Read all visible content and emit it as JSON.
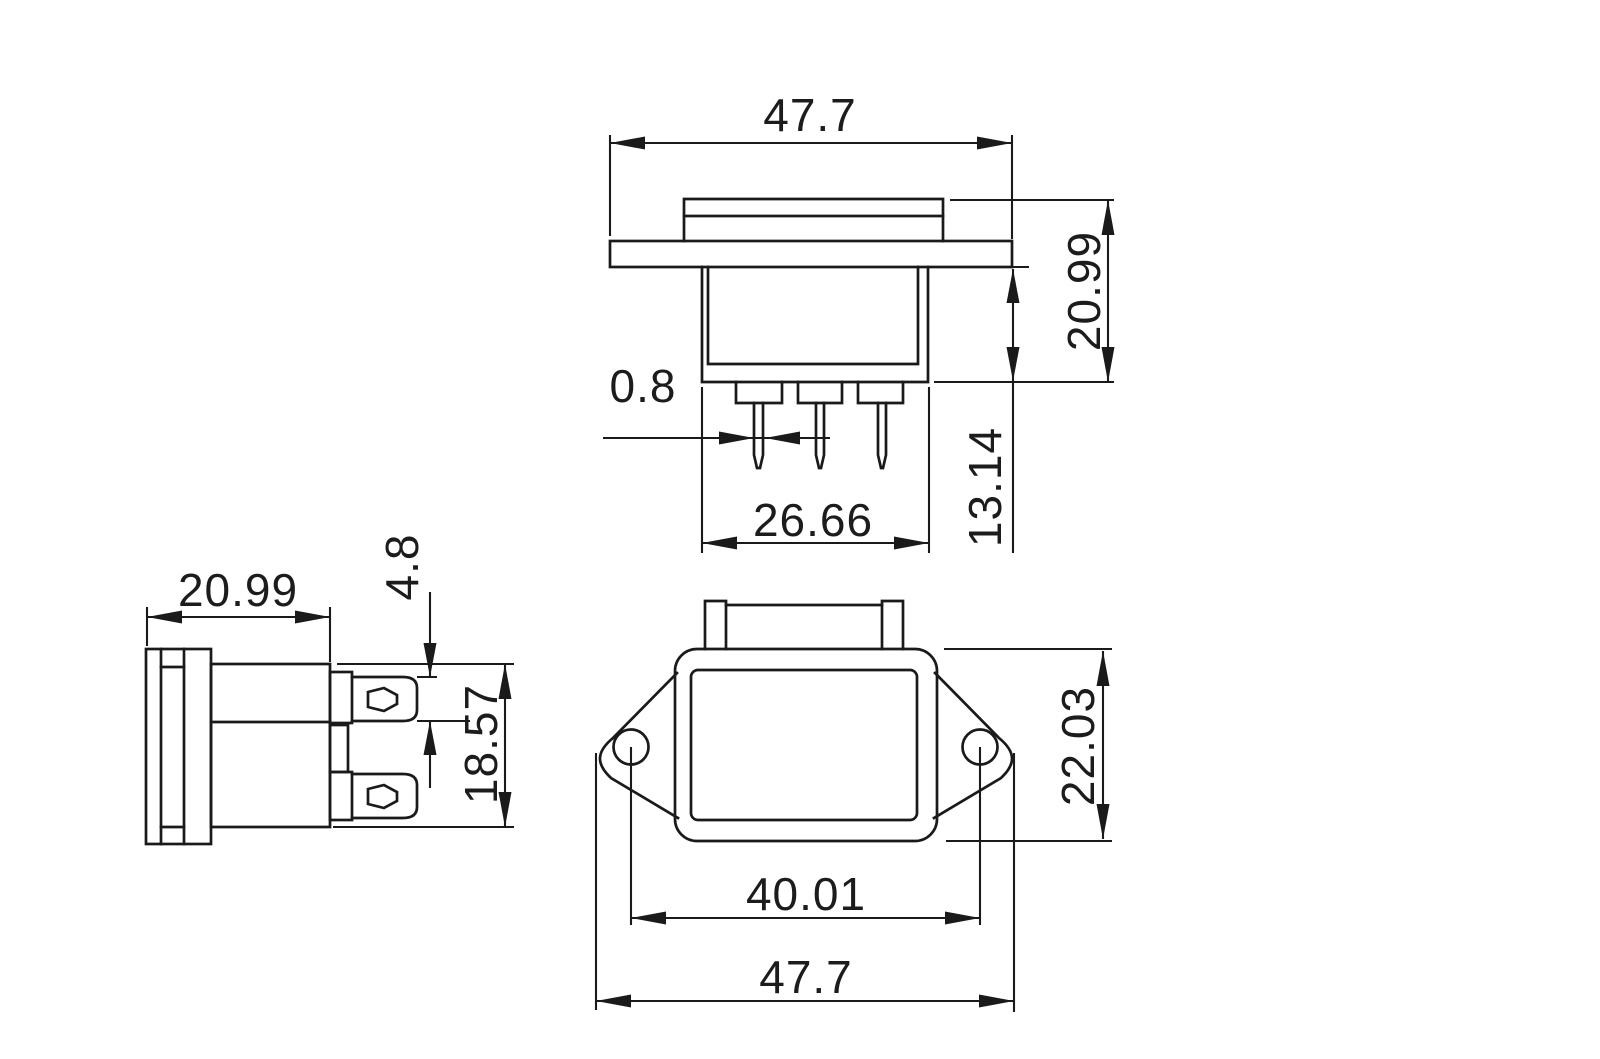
{
  "drawing": {
    "type": "3-view mechanical dimension drawing of panel-mount power inlet connector",
    "units_shown": false,
    "colors": {
      "line": "#1a1a1a",
      "background": "#ffffff"
    },
    "dims": {
      "top_width": "47.7",
      "top_height": "20.99",
      "body_depth": "13.14",
      "pin_thickness": "0.8",
      "pin_row_width": "26.66",
      "side_depth": "20.99",
      "terminal_width": "4.8",
      "side_body_height": "18.57",
      "hole_spacing": "40.01",
      "front_width": "47.7",
      "front_height": "22.03"
    }
  }
}
